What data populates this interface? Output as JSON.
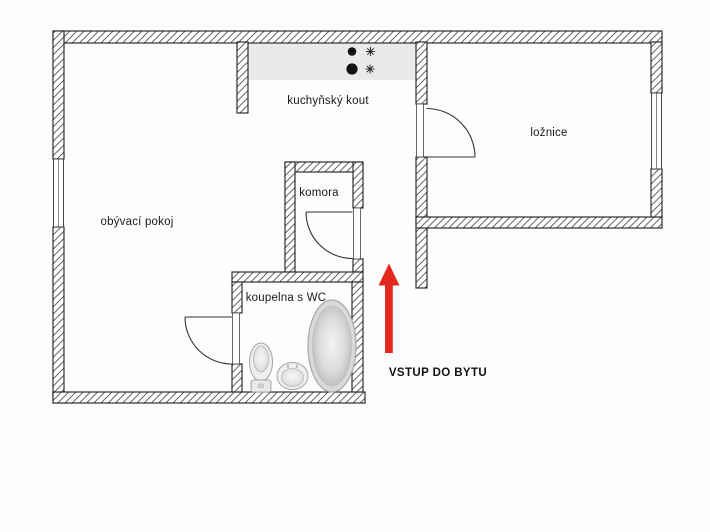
{
  "plan": {
    "type": "apartment-floor-plan",
    "background": "#fdfdfd"
  },
  "rooms": [
    {
      "name": "living-room",
      "label": "obývací pokoj"
    },
    {
      "name": "kitchen",
      "label": "kuchyňský kout"
    },
    {
      "name": "pantry",
      "label": "komora"
    },
    {
      "name": "bathroom",
      "label": "koupelna s WC"
    },
    {
      "name": "bedroom",
      "label": "ložnice"
    }
  ],
  "entrance": {
    "label": "VSTUP DO BYTU",
    "arrow_color": "#e3291f",
    "arrow_direction": "up"
  },
  "fixtures": [
    {
      "name": "stove-burners",
      "count": 2
    },
    {
      "name": "stove-star-symbols",
      "count": 2
    },
    {
      "name": "bathtub"
    },
    {
      "name": "toilet"
    },
    {
      "name": "sink"
    }
  ],
  "colors": {
    "wall_outline": "#1c1c1c",
    "wall_hatch": "#4d4d4d",
    "kitchen_counter": "#eaeaea",
    "arrow_red": "#e3291f"
  }
}
